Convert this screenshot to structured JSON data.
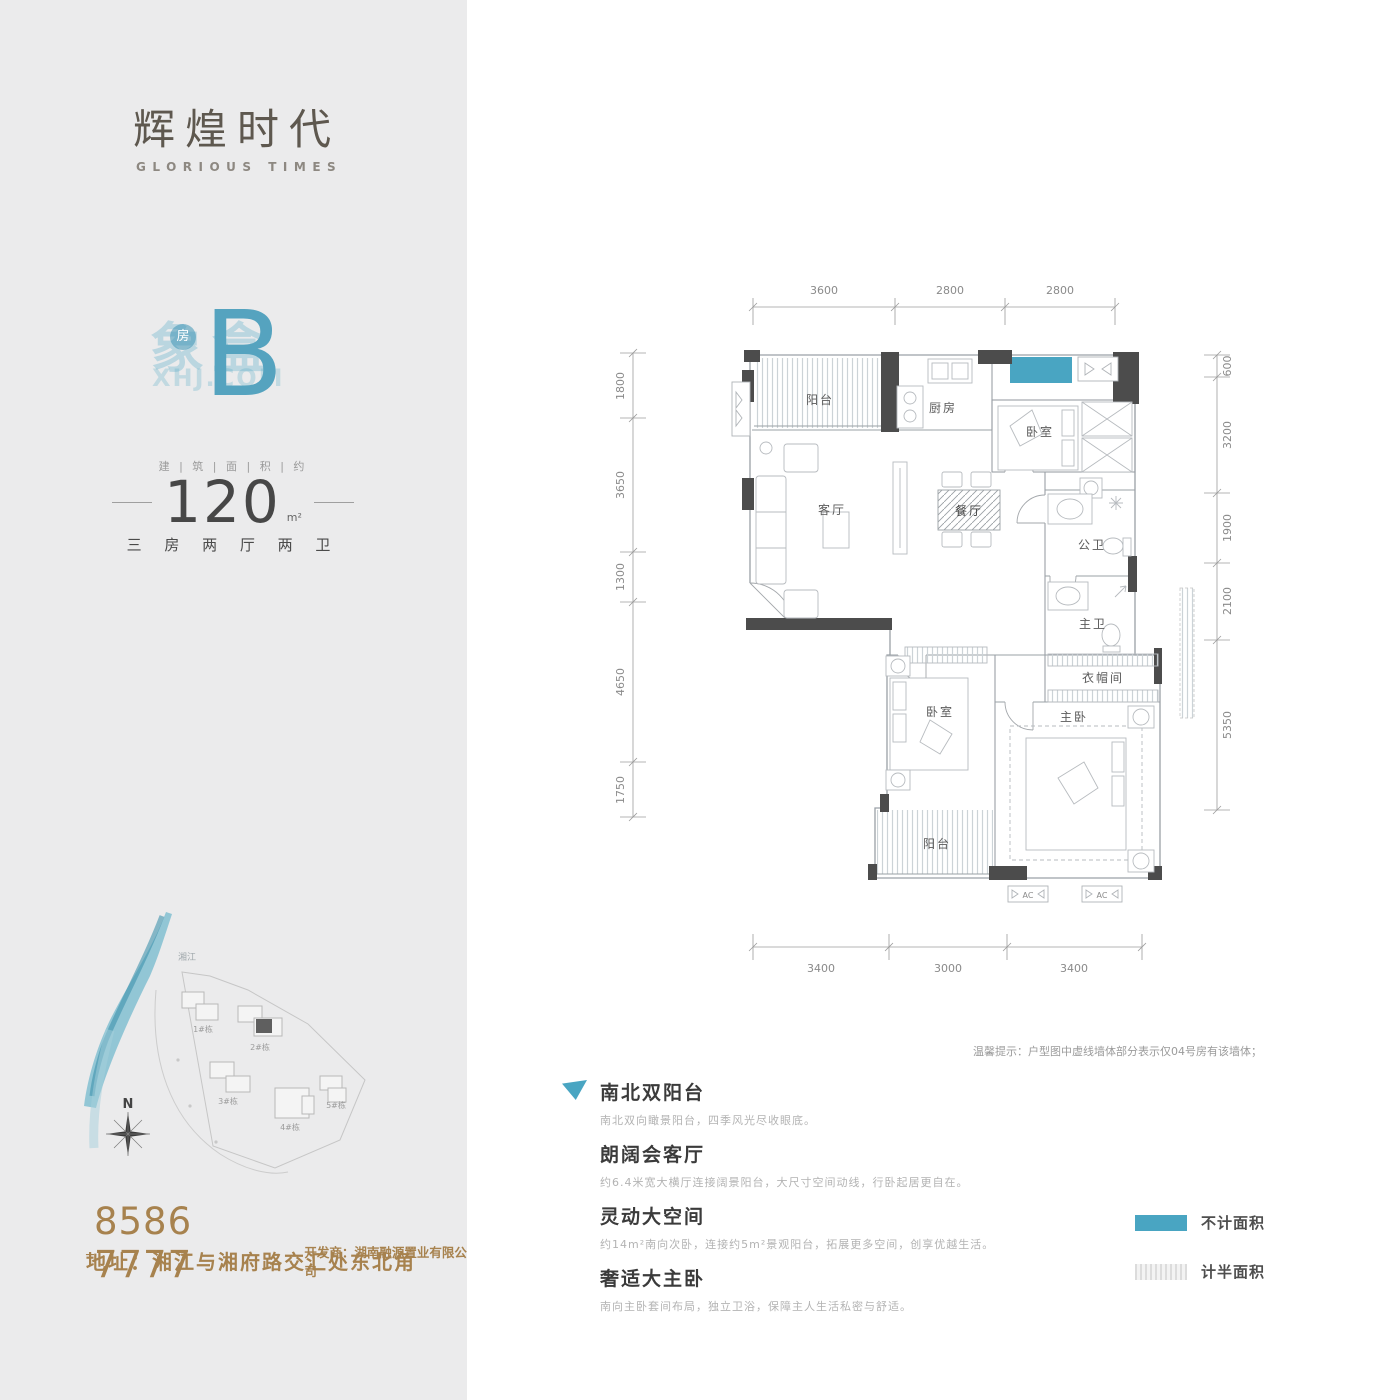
{
  "brand": {
    "name": "辉煌时代",
    "subtitle": "GLORIOUS TIMES"
  },
  "watermark": {
    "cn": "象盒",
    "en": "XHJ.COM",
    "dot": "房"
  },
  "unit": {
    "letter": "B",
    "area_label": "建 | 筑 | 面 | 积 | 约",
    "area_value": "120",
    "area_unit": "m²",
    "layout": "三 房 两 厅 两 卫"
  },
  "contact": {
    "phone_prefix": "T",
    "phone": "8586 7777",
    "developer": "开发商：湖南融源置业有限公司",
    "address": "地址：湘江与湘府路交汇处东北角"
  },
  "siteplan": {
    "river": "湘江",
    "north": "N",
    "buildings": [
      "1#栋",
      "2#栋",
      "3#栋",
      "4#栋",
      "5#栋"
    ]
  },
  "floorplan": {
    "dims_top": [
      "3600",
      "2800",
      "2800"
    ],
    "dims_left": [
      "1800",
      "3650",
      "1300",
      "4650",
      "1750"
    ],
    "dims_right": [
      "600",
      "3200",
      "1900",
      "2100",
      "5350"
    ],
    "dims_bottom": [
      "3400",
      "3000",
      "3400"
    ],
    "rooms": {
      "balcony_top": "阳台",
      "kitchen": "厨房",
      "bedroom_tr": "卧室",
      "living": "客厅",
      "dining": "餐厅",
      "bath_public": "公卫",
      "bath_master": "主卫",
      "closet": "衣帽间",
      "bedroom_ml": "卧室",
      "bedroom_master": "主卧",
      "balcony_bottom": "阳台"
    },
    "ac_label": "AC"
  },
  "note": "温馨提示：户型图中虚线墙体部分表示仅04号房有该墙体；",
  "features": [
    {
      "title": "南北双阳台",
      "desc": "南北双向瞰景阳台，四季风光尽收眼底。"
    },
    {
      "title": "朗阔会客厅",
      "desc": "约6.4米宽大横厅连接阔景阳台，大尺寸空间动线，行卧起居更自在。"
    },
    {
      "title": "灵动大空间",
      "desc": "约14m²南向次卧，连接约5m²景观阳台，拓展更多空间，创享优越生活。"
    },
    {
      "title": "奢适大主卧",
      "desc": "南向主卧套间布局，独立卫浴，保障主人生活私密与舒适。"
    }
  ],
  "legend": [
    {
      "label": "不计面积"
    },
    {
      "label": "计半面积"
    }
  ],
  "colors": {
    "accent": "#49a5c2",
    "brown": "#a7824e",
    "wall": "#4c4c4c",
    "panel": "#ebebec"
  }
}
